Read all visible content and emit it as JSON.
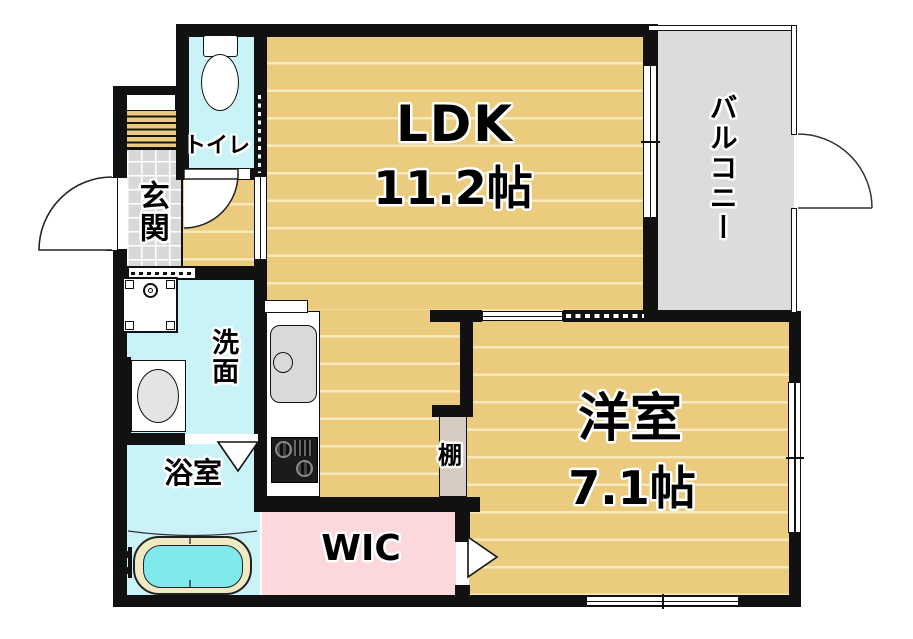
{
  "floorplan": {
    "title": "1LDK apartment floor plan",
    "rooms": {
      "ldk": {
        "label": "LDK",
        "size": "11.2帖"
      },
      "western_room": {
        "label": "洋室",
        "size": "7.1帖"
      },
      "balcony": {
        "label": "バルコニー"
      },
      "toilet": {
        "label": "トイレ"
      },
      "entrance": {
        "label": "玄関"
      },
      "washroom": {
        "label": "洗面"
      },
      "bathroom": {
        "label": "浴室"
      },
      "wic": {
        "label": "WIC"
      },
      "shelf": {
        "label": "棚"
      }
    },
    "colors": {
      "wood_floor": "#EBCB7E",
      "wood_stripe": "#F7E9BC",
      "wet_area": "#C9F3F6",
      "bath_water": "#80E9EC",
      "tub_rim": "#F0EAC4",
      "tile": "#D8D8D8",
      "balcony_floor": "#DCDCDC",
      "wic_pink": "#FAD8DB",
      "shelf_gray": "#D6CCC1",
      "wall": "#111111"
    }
  }
}
